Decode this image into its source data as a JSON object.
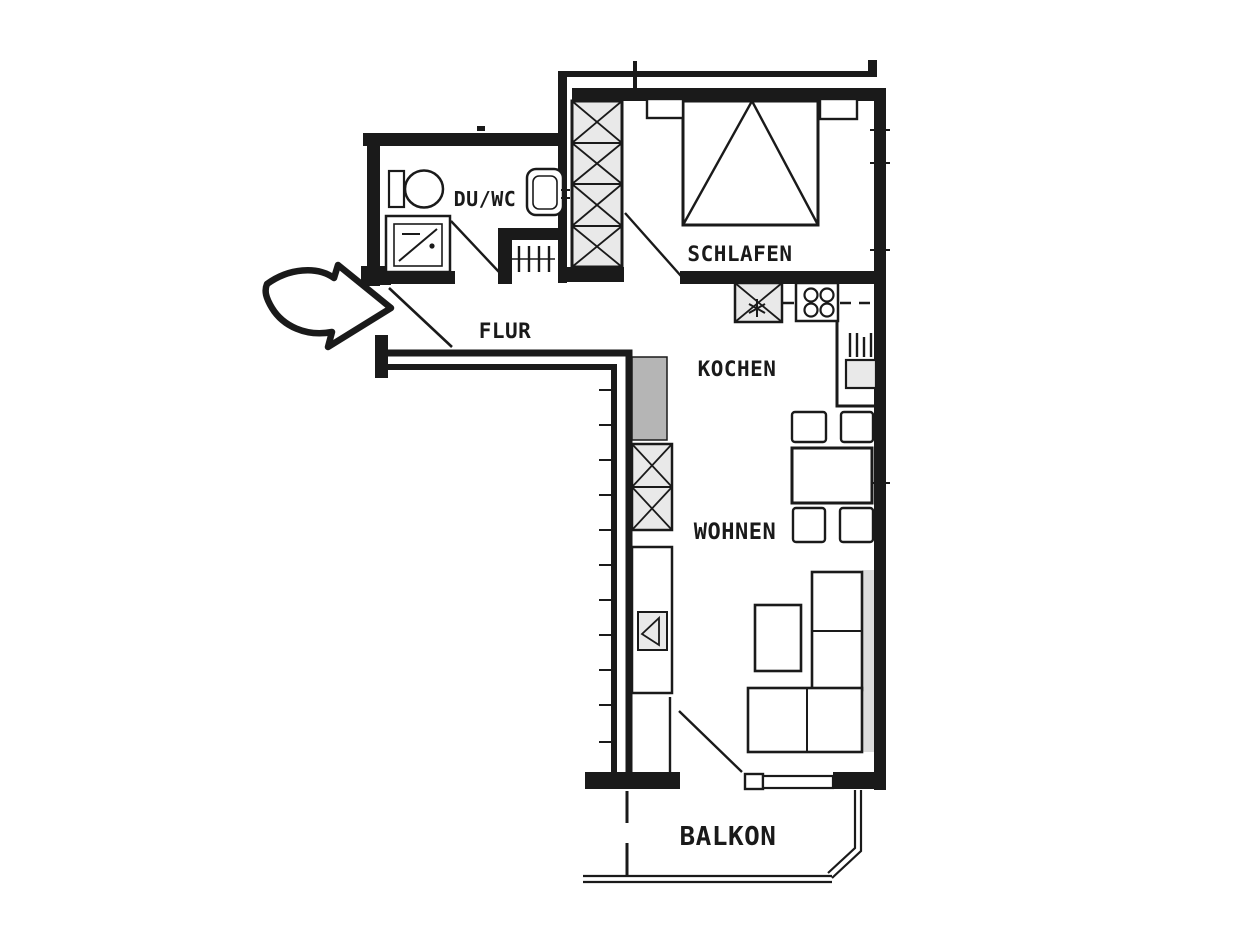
{
  "title": "Apartment floor plan",
  "colors": {
    "ink": "#1a1a1a",
    "shaft": "#b5b5b5",
    "fixture": "#e9e9e9",
    "shadow": "#dcdcdc",
    "bg": "#ffffff"
  },
  "rooms": {
    "duwc": {
      "label": "DU/WC"
    },
    "schlafen": {
      "label": "SCHLAFEN"
    },
    "flur": {
      "label": "FLUR"
    },
    "kochen": {
      "label": "KOCHEN"
    },
    "wohnen": {
      "label": "WOHNEN"
    },
    "balkon": {
      "label": "BALKON"
    }
  },
  "icons": {
    "entrance": "entrance-arrow-icon",
    "bed": "double-bed-icon",
    "bedroom_wardrobe": "wardrobe-x-icon",
    "living_wardrobe": "wardrobe-x-icon",
    "toilet": "toilet-icon",
    "washbasin": "washbasin-icon",
    "shower": "shower-icon",
    "radiator": "radiator-icon",
    "kitchen_sink": "kitchen-sink-icon",
    "stove": "stove-burners-icon",
    "water_heater": "water-heater-icon",
    "shaft": "duct-shaft-icon",
    "dining_table": "dining-table-icon",
    "chairs": "chair-icon",
    "sofa": "sofa-icon",
    "coffee_table": "coffee-table-icon",
    "tv_cabinet": "tv-cabinet-icon"
  }
}
